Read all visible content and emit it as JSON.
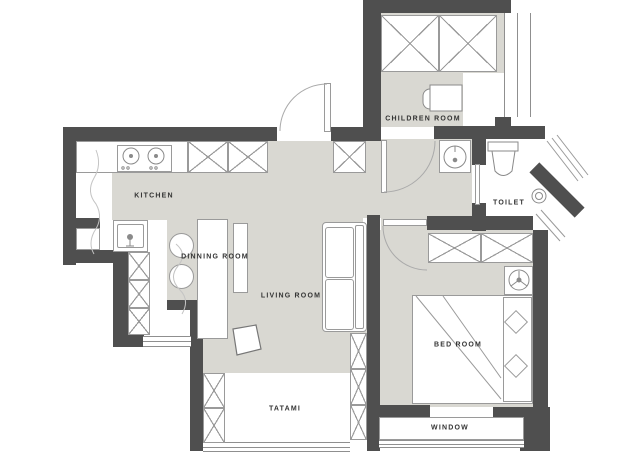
{
  "floor_plan": {
    "rooms": {
      "kitchen": {
        "label": "KITCHEN"
      },
      "dining": {
        "label": "DINNING ROOM"
      },
      "living": {
        "label": "LIVING ROOM"
      },
      "children": {
        "label": "CHILDREN ROOM"
      },
      "toilet": {
        "label": "TOILET"
      },
      "bedroom": {
        "label": "BED ROOM"
      },
      "tatami": {
        "label": "TATAMI"
      },
      "window": {
        "label": "WINDOW"
      }
    },
    "colors": {
      "wall": "#4f4f4f",
      "floor": "#d9d8d2",
      "outline": "#9a9a9a",
      "text": "#333333",
      "background": "#ffffff"
    }
  }
}
